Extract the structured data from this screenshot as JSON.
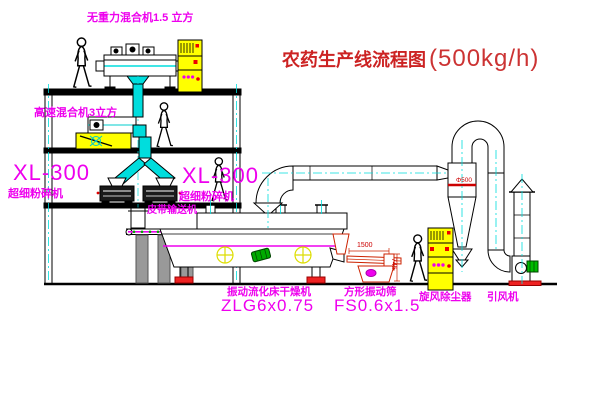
{
  "title": {
    "main": "农药生产线流程图",
    "capacity": "(500kg/h)"
  },
  "equipment_labels": {
    "gravity_mixer": "无重力混合机1.5 立方",
    "high_speed_mixer": "高速混合机3立方",
    "mill_left_model": "XL-300",
    "mill_left_name": "超细粉碎机",
    "mill_right_model": "XL-300",
    "mill_right_name": "超细粉碎机",
    "belt_conveyor": "皮带输送机",
    "dryer_name": "振动流化床干燥机",
    "dryer_model": "ZLG6x0.75",
    "sieve_name": "方形振动筛",
    "sieve_model": "FS0.6x1.5",
    "cyclone": "旋风除尘器",
    "fan": "引风机"
  },
  "dimensions": {
    "sieve_length": "1500",
    "sieve_height": "745",
    "cyclone_marking": "Φ500"
  },
  "colors": {
    "line": "#000000",
    "centerline": "#00dddd",
    "label_magenta": "#ee00ee",
    "title_red": "#cc2222",
    "cabinet_yellow": "#ffff00",
    "alert_red": "#ee0000",
    "motor_green": "#00aa00"
  }
}
